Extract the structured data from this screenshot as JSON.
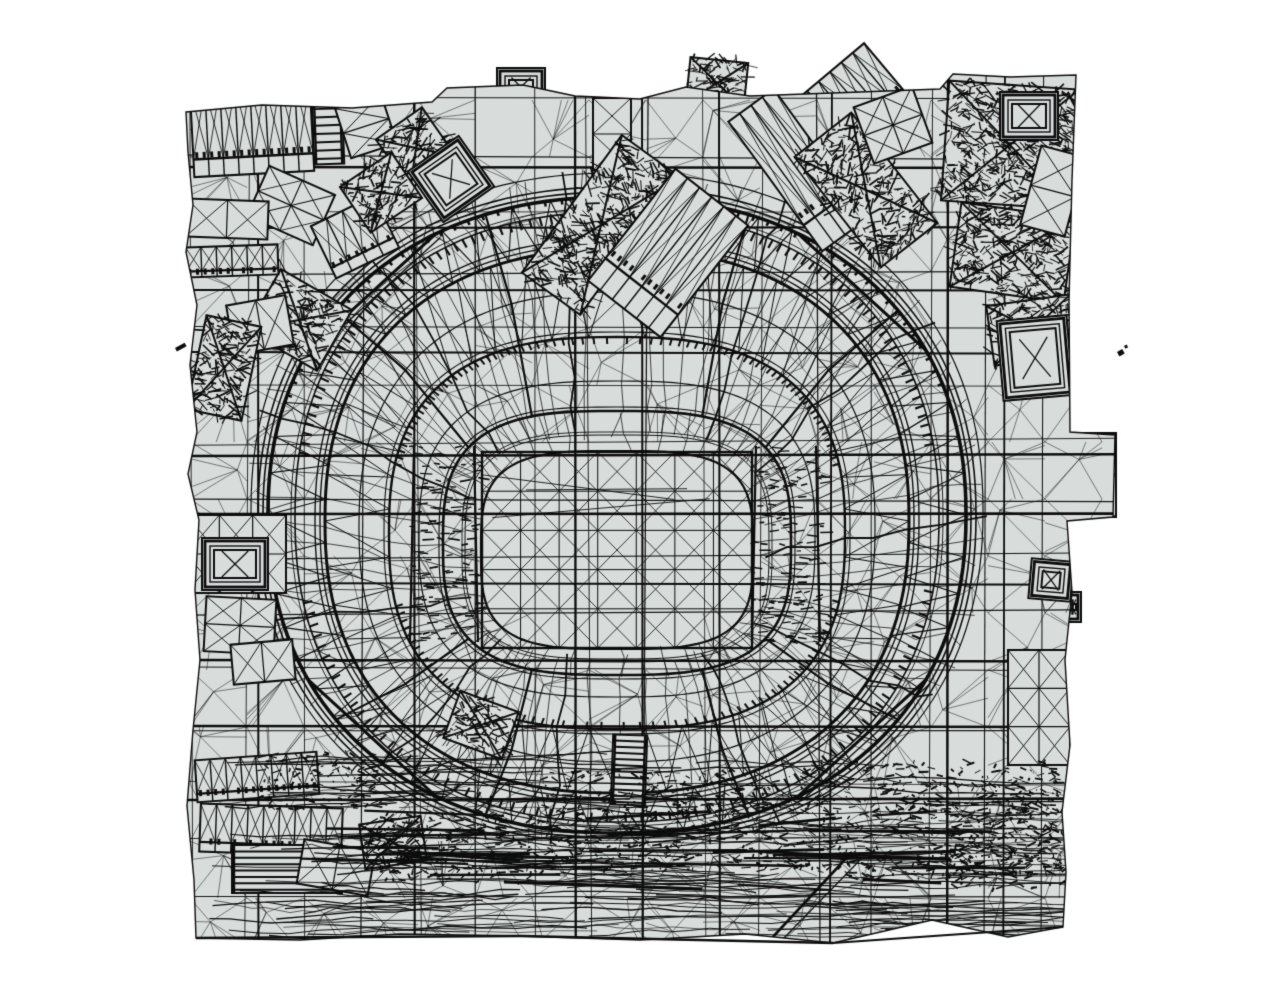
{
  "scene": {
    "width": 1271,
    "height": 1007,
    "background": "#ffffff",
    "mesh_fill": "#d8dddc",
    "line_color": "#0d0d0d",
    "seed": 1337,
    "footprint": [
      [
        186,
        112
      ],
      [
        262,
        105
      ],
      [
        352,
        108
      ],
      [
        432,
        102
      ],
      [
        447,
        88
      ],
      [
        523,
        85
      ],
      [
        575,
        96
      ],
      [
        640,
        99
      ],
      [
        686,
        87
      ],
      [
        750,
        96
      ],
      [
        860,
        92
      ],
      [
        940,
        89
      ],
      [
        953,
        74
      ],
      [
        1010,
        77
      ],
      [
        1076,
        75
      ],
      [
        1072,
        180
      ],
      [
        1069,
        300
      ],
      [
        1070,
        432
      ],
      [
        1115,
        435
      ],
      [
        1113,
        517
      ],
      [
        1067,
        521
      ],
      [
        1072,
        592
      ],
      [
        1065,
        660
      ],
      [
        1070,
        745
      ],
      [
        1062,
        812
      ],
      [
        1066,
        872
      ],
      [
        1063,
        927
      ],
      [
        1008,
        937
      ],
      [
        932,
        920
      ],
      [
        833,
        943
      ],
      [
        745,
        934
      ],
      [
        640,
        940
      ],
      [
        520,
        936
      ],
      [
        400,
        934
      ],
      [
        300,
        940
      ],
      [
        196,
        938
      ],
      [
        194,
        880
      ],
      [
        187,
        806
      ],
      [
        193,
        730
      ],
      [
        200,
        660
      ],
      [
        195,
        590
      ],
      [
        199,
        520
      ],
      [
        188,
        474
      ],
      [
        197,
        432
      ],
      [
        190,
        365
      ],
      [
        197,
        305
      ],
      [
        186,
        252
      ],
      [
        193,
        205
      ],
      [
        188,
        152
      ]
    ],
    "grid": {
      "spacing": 57,
      "x_start": 190,
      "y_start": 100,
      "heavy_vx": [
        258,
        414,
        575,
        642,
        719,
        832,
        948,
        1005
      ],
      "heavy_hy": [
        167,
        228,
        290,
        352,
        456,
        514,
        583,
        660,
        726,
        800
      ]
    },
    "stadium": {
      "cx": 617,
      "cy": 515,
      "rings": [
        {
          "rx": 136,
          "ry": 99,
          "n": 3.4,
          "dy": 35,
          "lw": 2.2,
          "passes": 1,
          "gap": 0
        },
        {
          "rx": 152,
          "ry": 112,
          "n": 3.2,
          "dy": 32,
          "lw": 1.0,
          "passes": 2,
          "gap": 3
        },
        {
          "rx": 174,
          "ry": 132,
          "n": 3.0,
          "dy": 28,
          "lw": 2.6,
          "passes": 2,
          "gap": 4
        },
        {
          "rx": 198,
          "ry": 158,
          "n": 2.8,
          "dy": 24,
          "lw": 1.2,
          "passes": 1,
          "gap": 0
        },
        {
          "rx": 228,
          "ry": 196,
          "n": 2.6,
          "dy": 18,
          "lw": 2.4,
          "passes": 2,
          "gap": 5
        },
        {
          "rx": 258,
          "ry": 235,
          "n": 2.4,
          "dy": 12,
          "lw": 1.2,
          "passes": 1,
          "gap": 0
        },
        {
          "rx": 292,
          "ry": 272,
          "n": 2.3,
          "dy": 6,
          "lw": 3.0,
          "passes": 3,
          "gap": 5
        },
        {
          "rx": 322,
          "ry": 305,
          "n": 2.25,
          "dy": 2,
          "lw": 1.6,
          "passes": 2,
          "gap": 4
        },
        {
          "rx": 349,
          "ry": 318,
          "n": 2.2,
          "dy": 0,
          "lw": 3.6,
          "passes": 3,
          "gap": 5
        },
        {
          "rx": 366,
          "ry": 338,
          "n": 2.2,
          "dy": -4,
          "lw": 1.2,
          "passes": 1,
          "gap": 0
        }
      ],
      "spokes": {
        "count": 88,
        "from": 1,
        "to": 9,
        "thick_every": 8,
        "jitter": 5
      },
      "inner_spokes": {
        "count": 44,
        "from": 0,
        "to": 2,
        "jitter": 3
      },
      "heavy_spoke_angles": [
        38,
        70,
        110,
        142,
        218,
        250,
        290,
        322
      ],
      "corner_chord_angles": [
        45,
        135,
        225,
        315
      ],
      "trusses": [
        {
          "a": 4,
          "b": 6,
          "steps": 96,
          "lw": 1.0
        },
        {
          "a": 6,
          "b": 8,
          "steps": 116,
          "lw": 1.1
        }
      ],
      "tribunes": [
        {
          "ring": 7,
          "th0": 190,
          "th1": 350,
          "step": 1.8,
          "len": 9,
          "lw": 2.2
        },
        {
          "ring": 7,
          "th0": 12,
          "th1": 168,
          "step": 2.2,
          "len": 9,
          "lw": 2.2
        },
        {
          "ring": 8,
          "th0": 200,
          "th1": 340,
          "step": 2.6,
          "len": 5,
          "lw": 2.6
        },
        {
          "ring": 4,
          "th0": 15,
          "th1": 165,
          "step": 2.4,
          "len": 7,
          "lw": 2.0
        },
        {
          "ring": 4,
          "th0": 195,
          "th1": 345,
          "step": 2.0,
          "len": 7,
          "lw": 2.0
        }
      ],
      "field": {
        "x0": 482,
        "y0": 452,
        "x1": 752,
        "y1": 648,
        "cols": 7,
        "rows": 5,
        "border_lw": 2.4
      },
      "side_stands": [
        {
          "x": 408,
          "y": 446,
          "w": 72,
          "h": 196,
          "dashes": 130
        },
        {
          "x": 750,
          "y": 446,
          "w": 72,
          "h": 196,
          "dashes": 130
        }
      ]
    },
    "buildings": [
      [
        192,
        86,
        120,
        88,
        -3,
        "bays"
      ],
      [
        313,
        92,
        30,
        72,
        -2,
        "ladder"
      ],
      [
        342,
        100,
        48,
        52,
        -18,
        "xgrid"
      ],
      [
        388,
        118,
        56,
        60,
        -35,
        "dense"
      ],
      [
        420,
        148,
        62,
        62,
        -35,
        "frame"
      ],
      [
        255,
        178,
        72,
        55,
        24,
        "xgrid"
      ],
      [
        320,
        208,
        70,
        58,
        -26,
        "bays"
      ],
      [
        350,
        165,
        62,
        55,
        -34,
        "dense"
      ],
      [
        258,
        285,
        82,
        70,
        30,
        "dense"
      ],
      [
        230,
        300,
        60,
        50,
        -10,
        "xgrid"
      ],
      [
        593,
        98,
        38,
        72,
        0,
        "xgrid"
      ],
      [
        565,
        140,
        72,
        170,
        36,
        "dense"
      ],
      [
        622,
        182,
        92,
        142,
        38,
        "bays"
      ],
      [
        770,
        90,
        56,
        160,
        -36,
        "bays"
      ],
      [
        830,
        120,
        72,
        140,
        -38,
        "dense"
      ],
      [
        862,
        95,
        62,
        60,
        -20,
        "xgrid"
      ],
      [
        945,
        85,
        130,
        120,
        4,
        "dense"
      ],
      [
        1000,
        92,
        58,
        48,
        0,
        "frame"
      ],
      [
        955,
        210,
        115,
        85,
        8,
        "dense"
      ],
      [
        990,
        300,
        85,
        60,
        -8,
        "dense"
      ],
      [
        1030,
        150,
        46,
        82,
        15,
        "xgrid"
      ],
      [
        186,
        200,
        82,
        38,
        2,
        "xgrid"
      ],
      [
        186,
        246,
        92,
        30,
        -2,
        "bays"
      ],
      [
        196,
        320,
        56,
        96,
        12,
        "dense"
      ],
      [
        186,
        515,
        100,
        78,
        0,
        "xgrid"
      ],
      [
        202,
        538,
        66,
        52,
        0,
        "frame"
      ],
      [
        205,
        598,
        70,
        55,
        3,
        "xgrid"
      ],
      [
        232,
        642,
        62,
        40,
        -5,
        "xgrid"
      ],
      [
        1000,
        318,
        70,
        80,
        -5,
        "frame"
      ],
      [
        1008,
        650,
        62,
        115,
        0,
        "xgrid"
      ],
      [
        1030,
        560,
        42,
        40,
        5,
        "frame"
      ],
      [
        196,
        756,
        122,
        42,
        -4,
        "bays"
      ],
      [
        200,
        806,
        142,
        48,
        2,
        "bays"
      ],
      [
        232,
        845,
        110,
        48,
        0,
        "ladder"
      ],
      [
        300,
        845,
        72,
        45,
        10,
        "xgrid"
      ],
      [
        362,
        820,
        62,
        45,
        -8,
        "dense"
      ],
      [
        612,
        735,
        34,
        70,
        2,
        "ladder"
      ],
      [
        450,
        700,
        62,
        50,
        20,
        "dense"
      ]
    ],
    "outbuildings": [
      [
        497,
        68,
        48,
        38,
        0,
        "frame"
      ],
      [
        688,
        60,
        58,
        46,
        6,
        "dense"
      ],
      [
        796,
        68,
        104,
        74,
        -40,
        "bays"
      ],
      [
        1068,
        433,
        48,
        84,
        0,
        "xgrid"
      ],
      [
        1064,
        592,
        17,
        30,
        0,
        "frame"
      ]
    ],
    "vegetation": {
      "x0": 205,
      "x1": 1068,
      "y0": 752,
      "y1": 938,
      "streaks": 170,
      "thick_streaks": 28,
      "patches": [
        [
          545,
          770,
          250,
          100
        ],
        [
          800,
          762,
          270,
          118
        ],
        [
          380,
          812,
          160,
          70
        ],
        [
          950,
          800,
          118,
          88
        ],
        [
          262,
          752,
          118,
          58
        ]
      ]
    },
    "specks": [
      [
        1117,
        352,
        6,
        5
      ],
      [
        1124,
        346,
        3,
        3
      ],
      [
        175,
        348,
        11,
        4
      ]
    ]
  }
}
